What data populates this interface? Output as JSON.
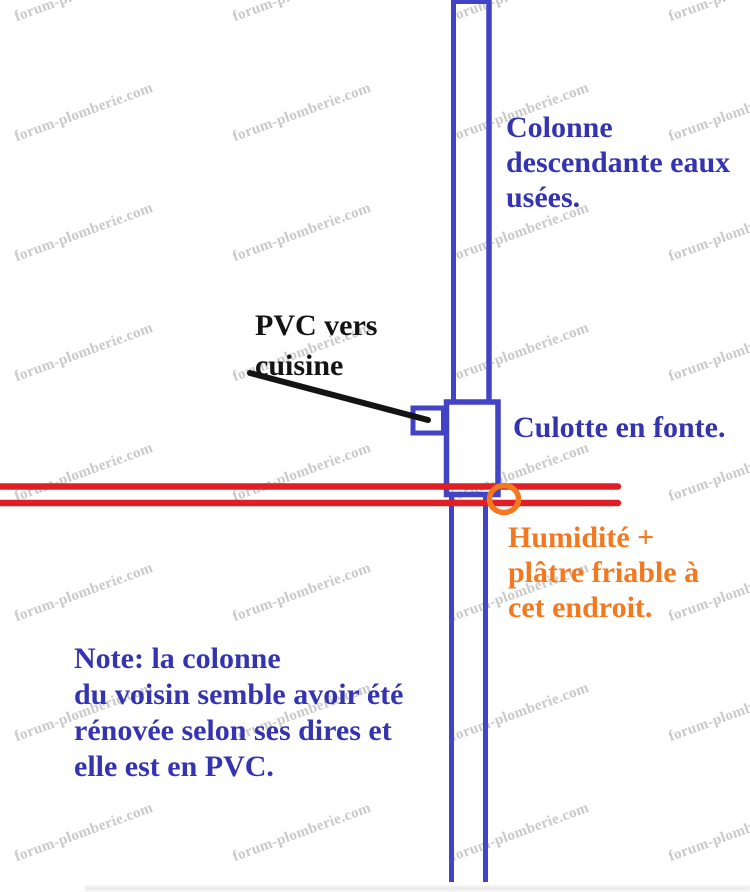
{
  "watermark": {
    "text": "forum-plomberie.com",
    "color": "#c9c9c9",
    "angle_deg": -20,
    "grid_cols_x": [
      84,
      302,
      520,
      738
    ],
    "grid_rows_y": [
      -7,
      113,
      233,
      353,
      473,
      593,
      713,
      833
    ]
  },
  "colors": {
    "pipe_blue": "#4343c6",
    "text_blue": "#3434b2",
    "red_line": "#de2026",
    "orange": "#f2791f",
    "black": "#141414"
  },
  "annotations": {
    "colonne": {
      "lines": [
        "Colonne",
        "descendante eaux",
        "usées."
      ]
    },
    "pvc_cuisine": {
      "lines": [
        "PVC vers",
        "cuisine"
      ]
    },
    "culotte": {
      "lines": [
        "Culotte en fonte."
      ]
    },
    "humidite": {
      "lines": [
        "Humidité +",
        "plâtre friable à",
        "cet endroit."
      ]
    },
    "note": {
      "lines": [
        "Note: la colonne",
        "du voisin semble avoir été",
        "rénovée selon ses dires et",
        "elle est en PVC."
      ]
    }
  }
}
